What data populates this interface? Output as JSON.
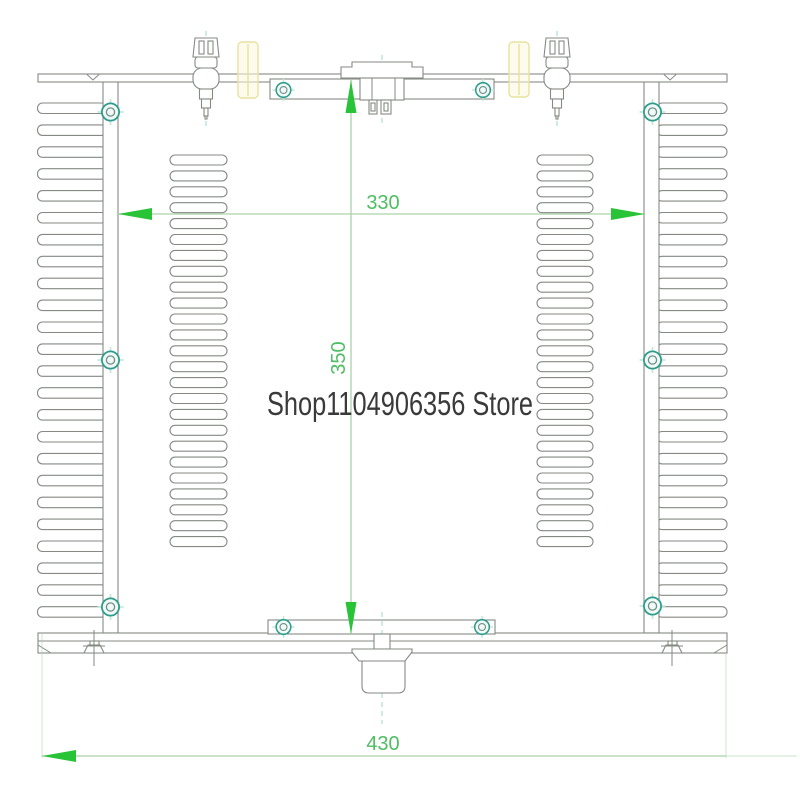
{
  "watermark": {
    "text": "Shop1104906356 Store"
  },
  "dimensions": {
    "inner_width": {
      "label": "330"
    },
    "chassis_depth": {
      "label": "350"
    },
    "overall_width": {
      "label": "430"
    }
  },
  "drawing": {
    "heatsink_fin_count": 24,
    "vent_slot_count": 25,
    "wall_screw_count": 6,
    "bracket_screw_count": 4,
    "binding_post_count": 2,
    "highlighted_part_count": 2
  },
  "colors": {
    "line_gray": "#858a85",
    "dim_line": "#a9d3a9",
    "arrow_green": "#28c336",
    "dim_text": "#4fbd63",
    "centerline_teal": "#9fd8cc",
    "screw_teal": "#2e9c8c",
    "screw_glow": "#c5e9d6",
    "highlight_yellow": "#fbf8dd",
    "highlight_yellow_border": "#e8e2a0",
    "watermark_gray": "#3a3a3a"
  }
}
